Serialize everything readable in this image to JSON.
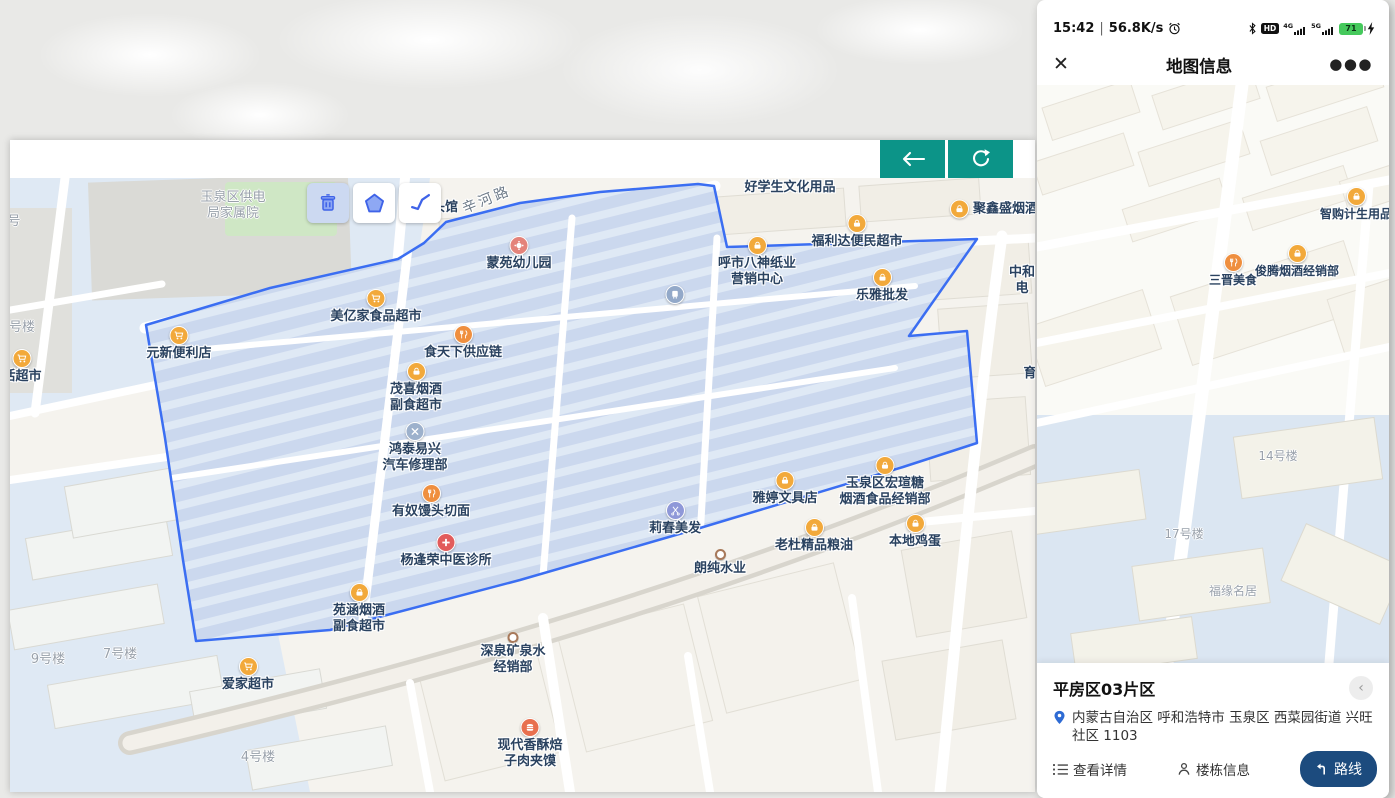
{
  "window": {
    "toolbar": {
      "back_icon": "arrow-left",
      "refresh_icon": "refresh"
    },
    "tools": [
      "delete",
      "draw-polygon",
      "draw-line"
    ]
  },
  "left_map": {
    "polygon_color": "#3b6ef2",
    "pois": [
      {
        "n": "area-gongdianju-jiashuyuan",
        "x": 223,
        "y": 20,
        "lines": [
          "玉泉区供电",
          "局家属院"
        ],
        "k": "area"
      },
      {
        "n": "area-hao-partial",
        "x": 4,
        "y": 44,
        "lines": [
          "号"
        ],
        "k": "area"
      },
      {
        "n": "area-haolou-partial",
        "x": 12,
        "y": 150,
        "lines": [
          "号楼"
        ],
        "k": "area"
      },
      {
        "n": "poi-huo-chaoshi",
        "x": 12,
        "y": 180,
        "lines": [
          "活超市"
        ],
        "icon": "cart",
        "c": "#f2a93b"
      },
      {
        "n": "poi-yuanxin-bianlidian",
        "x": 169,
        "y": 157,
        "lines": [
          "元新便利店"
        ],
        "icon": "cart",
        "c": "#f2a93b"
      },
      {
        "n": "poi-meiyijia-chaoshi",
        "x": 366,
        "y": 120,
        "lines": [
          "美亿家食品超市"
        ],
        "icon": "cart",
        "c": "#f2a93b"
      },
      {
        "n": "poi-toukan-partial",
        "x": 435,
        "y": 30,
        "lines": [
          "头馆"
        ]
      },
      {
        "n": "road-xinhelu",
        "x": 477,
        "y": 22,
        "lines": [
          "辛河路"
        ],
        "k": "road",
        "rot": -22
      },
      {
        "n": "poi-mengyuan-youeryuan",
        "x": 509,
        "y": 67,
        "lines": [
          "蒙苑幼儿园"
        ],
        "icon": "kid",
        "c": "#e4837a"
      },
      {
        "n": "poi-shitianxia",
        "x": 453,
        "y": 156,
        "lines": [
          "食天下供应链"
        ],
        "icon": "food",
        "c": "#ef8f3f"
      },
      {
        "n": "poi-maoxi-yanjiu",
        "x": 406,
        "y": 193,
        "lines": [
          "茂喜烟酒",
          "副食超市"
        ],
        "icon": "bag",
        "c": "#f2a93b"
      },
      {
        "n": "poi-hongtai-qixiu",
        "x": 405,
        "y": 253,
        "lines": [
          "鸿泰易兴",
          "汽车修理部"
        ],
        "icon": "wrench",
        "c": "#9db1cc"
      },
      {
        "n": "poi-younu-mantou",
        "x": 421,
        "y": 315,
        "lines": [
          "有奴馒头切面"
        ],
        "icon": "food",
        "c": "#ef8f3f"
      },
      {
        "n": "poi-yangfengrong-zhensuo",
        "x": 436,
        "y": 364,
        "lines": [
          "杨逢荣中医诊所"
        ],
        "icon": "medical",
        "c": "#e25c5c"
      },
      {
        "n": "poi-yuanhan-yanjiu",
        "x": 349,
        "y": 414,
        "lines": [
          "苑涵烟酒",
          "副食超市"
        ],
        "icon": "bag",
        "c": "#f2a93b"
      },
      {
        "n": "poi-aijia-chaoshi",
        "x": 238,
        "y": 488,
        "lines": [
          "爱家超市"
        ],
        "icon": "cart",
        "c": "#f2a93b"
      },
      {
        "n": "poi-transit",
        "x": 665,
        "y": 116,
        "lines": [],
        "icon": "transit",
        "c": "#93a9c9"
      },
      {
        "n": "poi-haoxuesheng-wenhua",
        "x": 780,
        "y": 10,
        "lines": [
          "好学生文化用品"
        ]
      },
      {
        "n": "poi-juxinsheng-yanjiu",
        "x": 949,
        "y": 31,
        "lines": [
          "聚鑫盛烟酒"
        ],
        "icon": "bag",
        "c": "#f2a93b",
        "side": "right"
      },
      {
        "n": "poi-fulida-chaoshi",
        "x": 847,
        "y": 45,
        "lines": [
          "福利达便民超市"
        ],
        "icon": "bag",
        "c": "#f2a93b"
      },
      {
        "n": "poi-hushi-bashen",
        "x": 747,
        "y": 67,
        "lines": [
          "呼市八神纸业",
          "营销中心"
        ],
        "icon": "bag",
        "c": "#f2a93b"
      },
      {
        "n": "poi-leya-pifa",
        "x": 872,
        "y": 99,
        "lines": [
          "乐雅批发"
        ],
        "icon": "bag",
        "c": "#f2a93b"
      },
      {
        "n": "poi-zhonghe-partial",
        "x": 1012,
        "y": 95,
        "lines": [
          "中和",
          "电"
        ]
      },
      {
        "n": "poi-yu-partial",
        "x": 1020,
        "y": 196,
        "lines": [
          "育"
        ]
      },
      {
        "n": "poi-hongxuan-jingxiaobu",
        "x": 875,
        "y": 287,
        "lines": [
          "玉泉区宏瑄糖",
          "烟酒食品经销部"
        ],
        "icon": "bag",
        "c": "#f2a93b"
      },
      {
        "n": "poi-yating-wenjudian",
        "x": 775,
        "y": 302,
        "lines": [
          "雅婷文具店"
        ],
        "icon": "bag",
        "c": "#f2a93b"
      },
      {
        "n": "poi-lichun-meifa",
        "x": 665,
        "y": 332,
        "lines": [
          "莉春美发"
        ],
        "icon": "scissors",
        "c": "#8f98d8"
      },
      {
        "n": "poi-laodu-liangyou",
        "x": 804,
        "y": 349,
        "lines": [
          "老杜精品粮油"
        ],
        "icon": "bag",
        "c": "#f2a93b"
      },
      {
        "n": "poi-bendi-jidan",
        "x": 905,
        "y": 345,
        "lines": [
          "本地鸡蛋"
        ],
        "icon": "bag",
        "c": "#f2a93b"
      },
      {
        "n": "poi-langchun-shuiye",
        "x": 710,
        "y": 380,
        "lines": [
          "朗纯水业"
        ],
        "icon": "dot"
      },
      {
        "n": "poi-shenquan-kuangquanshui",
        "x": 503,
        "y": 463,
        "lines": [
          "深泉矿泉水",
          "经销部"
        ],
        "icon": "dot"
      },
      {
        "n": "poi-xiandai-xiangsu",
        "x": 520,
        "y": 549,
        "lines": [
          "现代香酥焙",
          "子肉夹馍"
        ],
        "icon": "burger",
        "c": "#e8704f"
      },
      {
        "n": "area-9haolou",
        "x": 38,
        "y": 482,
        "lines": [
          "9号楼"
        ],
        "k": "area"
      },
      {
        "n": "area-7haolou",
        "x": 110,
        "y": 477,
        "lines": [
          "7号楼"
        ],
        "k": "area"
      },
      {
        "n": "area-4haolou",
        "x": 248,
        "y": 580,
        "lines": [
          "4号楼"
        ],
        "k": "area"
      }
    ]
  },
  "phone": {
    "status_bar": {
      "time": "15:42",
      "sep": "|",
      "speed": "56.8K/s",
      "hd": "HD",
      "net1": "4G",
      "net2": "5G",
      "battery": "71"
    },
    "header": {
      "title": "地图信息",
      "close_icon": "close",
      "more_icon": "more-ellipsis"
    },
    "card": {
      "title": "平房区03片区",
      "address": "内蒙古自治区 呼和浩特市 玉泉区 西菜园街道 兴旺社区 1103",
      "details_label": "查看详情",
      "buildings_label": "楼栋信息",
      "route_label": "路线",
      "route_color": "#1c4b7e"
    }
  },
  "phone_map": {
    "pois": [
      {
        "n": "poi-zhigou-jisheng",
        "x": 319,
        "y": 111,
        "lines": [
          "智购计生用品"
        ],
        "icon": "bag",
        "c": "#f2a93b"
      },
      {
        "n": "poi-sanjin-meishi",
        "x": 196,
        "y": 177,
        "lines": [
          "三晋美食"
        ],
        "icon": "food",
        "c": "#ef8f3f"
      },
      {
        "n": "poi-junteng-yanjiu",
        "x": 260,
        "y": 168,
        "lines": [
          "俊腾烟酒经销部"
        ],
        "icon": "bag",
        "c": "#f2a93b"
      },
      {
        "n": "area-14haolou",
        "x": 241,
        "y": 372,
        "lines": [
          "14号楼"
        ],
        "k": "area"
      },
      {
        "n": "area-17haolou",
        "x": 147,
        "y": 450,
        "lines": [
          "17号楼"
        ],
        "k": "area"
      },
      {
        "n": "area-fuyuan-mingju",
        "x": 196,
        "y": 507,
        "lines": [
          "福缘名居"
        ],
        "k": "area"
      }
    ]
  }
}
